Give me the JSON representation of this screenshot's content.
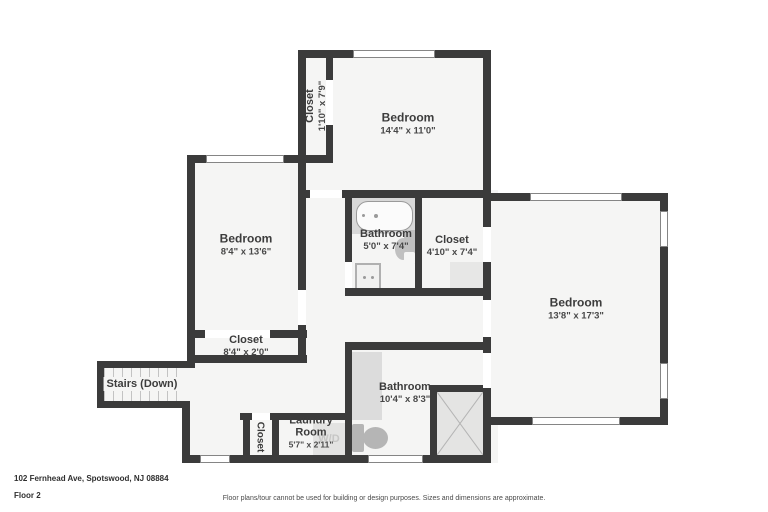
{
  "rooms": {
    "top_closet": {
      "name": "Closet",
      "dims": "1'10\" x 7'9\""
    },
    "top_bedroom": {
      "name": "Bedroom",
      "dims": "14'4\" x 11'0\""
    },
    "left_bedroom": {
      "name": "Bedroom",
      "dims": "8'4\" x 13'6\""
    },
    "mid_bathroom": {
      "name": "Bathroom",
      "dims": "5'0\" x 7'4\""
    },
    "mid_closet": {
      "name": "Closet",
      "dims": "4'10\" x 7'4\""
    },
    "right_bedroom": {
      "name": "Bedroom",
      "dims": "13'8\" x 17'3\""
    },
    "hall_closet": {
      "name": "Closet",
      "dims": "8'4\" x 2'0\""
    },
    "stairs": {
      "name": "Stairs (Down)"
    },
    "bottom_closet": {
      "name": "Closet"
    },
    "laundry": {
      "name": "Laundry Room",
      "dims": "5'7\" x 2'11\""
    },
    "bottom_bathroom": {
      "name": "Bathroom",
      "dims": "10'4\" x 8'3\""
    }
  },
  "fixtures": {
    "washer_dryer_label": "W/D"
  },
  "footer": {
    "address": "102 Fernhead Ave, Spotswood, NJ 08884",
    "floor": "Floor 2",
    "disclaimer": "Floor plans/tour cannot be used for building or design purposes. Sizes and dimensions are approximate."
  },
  "colors": {
    "wall": "#3b3b3b",
    "room_fill": "#f5f5f4",
    "fixture_gray": "#d8d8d8"
  }
}
